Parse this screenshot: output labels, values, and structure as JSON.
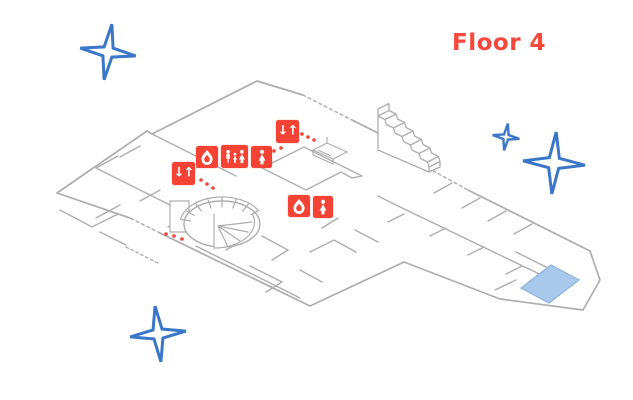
{
  "header": {
    "floor_label": "Floor 4"
  },
  "map": {
    "elevator_glyph": "↓↑",
    "markers": [
      {
        "name": "elevator-marker-1",
        "type": "elevator"
      },
      {
        "name": "fire-safety-marker-1",
        "type": "fire-safety"
      },
      {
        "name": "family-restroom-marker",
        "type": "family-restroom"
      },
      {
        "name": "womens-restroom-marker-1",
        "type": "womens-restroom"
      },
      {
        "name": "elevator-marker-2",
        "type": "elevator"
      },
      {
        "name": "fire-safety-marker-2",
        "type": "fire-safety"
      },
      {
        "name": "womens-restroom-marker-2",
        "type": "womens-restroom"
      }
    ],
    "features": [
      "straight-staircase",
      "spiral-staircase",
      "highlighted-room"
    ],
    "decoration": {
      "sparkle_star_count": 4
    }
  },
  "colors": {
    "accent_red": "#F44334",
    "title_red": "#F8473C",
    "wall_gray": "#ADADAD",
    "star_blue": "#3B76C9",
    "room_highlight_fill": "#A8C8EC",
    "room_highlight_stroke": "#8CB2DC"
  }
}
